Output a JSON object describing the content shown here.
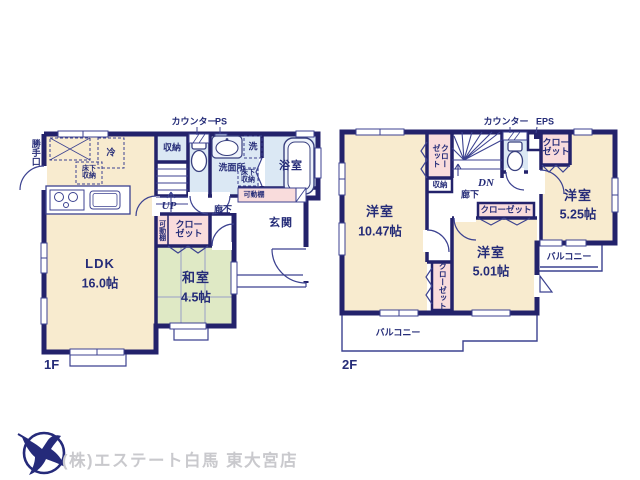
{
  "page": {
    "type": "floorplan",
    "background": "#ffffff"
  },
  "colors": {
    "wall_navy": "#23226b",
    "label_navy": "#252c78",
    "room_cream": "#f8ebcf",
    "tatami_green": "#dfe9c5",
    "water_blue": "#dbe8f4",
    "closet_pink": "#f9dcdc",
    "footer_gray": "#c9c9cd",
    "logo_navy": "#252a7a"
  },
  "floor1": {
    "label": "1F",
    "exterior": {
      "back_door": "勝手口",
      "counter": "カウンター",
      "pipe_space": "PS"
    },
    "rooms": {
      "ldk": {
        "name": "LDK",
        "size": "16.0帖"
      },
      "washitsu": {
        "name": "和室",
        "size": "4.5帖"
      },
      "genkan": "玄関",
      "roka": "廊下",
      "senmenjo": "洗面所",
      "yokushitsu": "浴室",
      "shuno": "収納",
      "closet": "クローゼット",
      "kadodana_vertical": "可動棚",
      "kadodana_horizontal": "可動棚",
      "yukashita_kitchen": "床下収納",
      "yukashita_senmen": "床下収納",
      "refrigerator": "冷",
      "washer": "洗",
      "stairs_up": "UP"
    }
  },
  "floor2": {
    "label": "2F",
    "exterior": {
      "counter": "カウンター",
      "eps": "EPS"
    },
    "rooms": {
      "yoshitsu_a": {
        "name": "洋室",
        "size": "10.47帖"
      },
      "yoshitsu_b": {
        "name": "洋室",
        "size": "5.01帖"
      },
      "yoshitsu_c": {
        "name": "洋室",
        "size": "5.25帖"
      },
      "closet_nw": "クローゼット",
      "closet_ne": "クローゼット",
      "closet_mid": "クローゼット",
      "closet_south": "クローゼット",
      "shuno": "収納",
      "roka": "廊下",
      "stairs_down": "DN",
      "balcony_right": "バルコニー",
      "balcony_bottom": "バルコニー"
    }
  },
  "footer": {
    "company": "(株)エステート白馬 東大宮店"
  }
}
